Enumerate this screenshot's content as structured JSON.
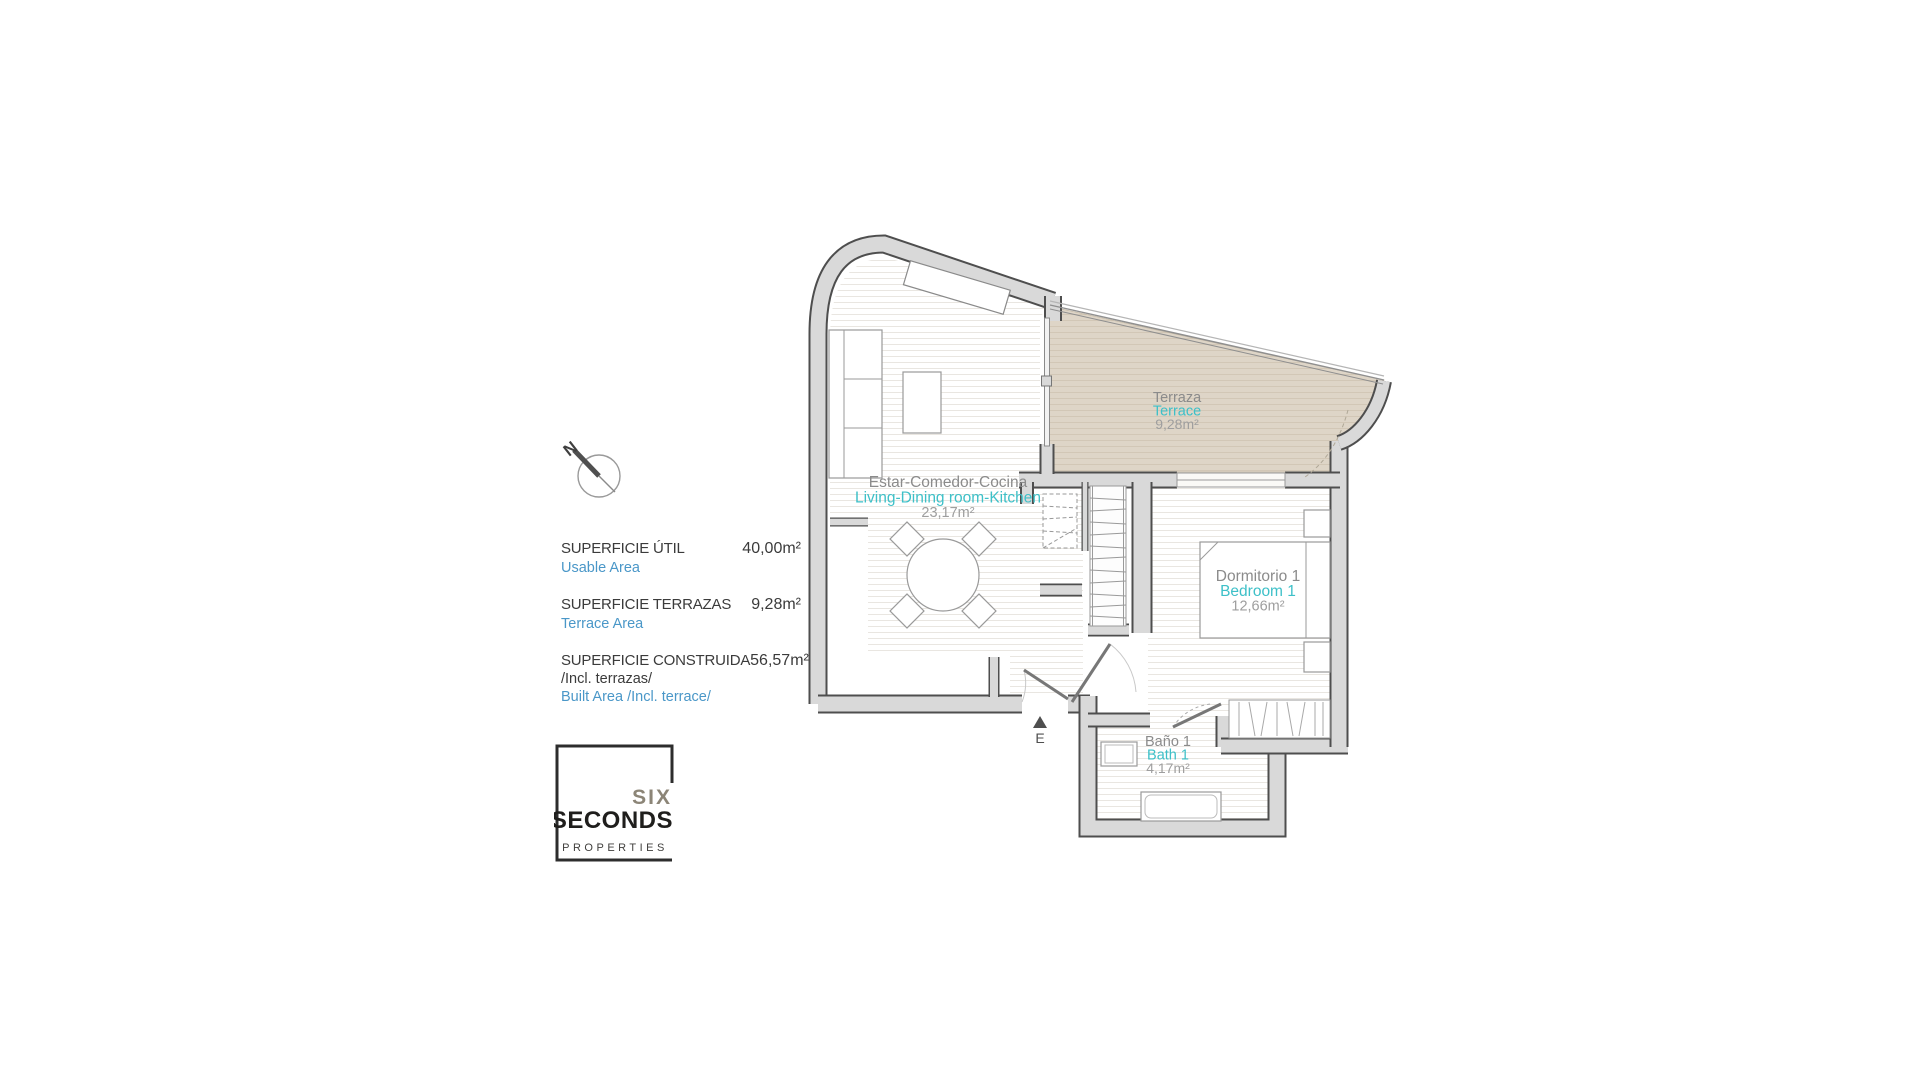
{
  "compass": {
    "label": "N"
  },
  "legend": {
    "rows": [
      {
        "title": "SUPERFICIE ÚTIL",
        "subtitle": "Usable Area",
        "value": "40,00m²"
      },
      {
        "title": "SUPERFICIE TERRAZAS",
        "subtitle": "Terrace Area",
        "value": "9,28m²"
      },
      {
        "title": "SUPERFICIE CONSTRUIDA",
        "title2": "/Incl. terrazas/",
        "subtitle": "Built Area /Incl. terrace/",
        "value": "56,57m²"
      }
    ]
  },
  "logo": {
    "word1": "SIX",
    "word2": "SECONDS",
    "word3": "PROPERTIES"
  },
  "floorplan": {
    "entrance_label": "E",
    "rooms": {
      "living": {
        "name_es": "Estar-Comedor-Cocina",
        "name_en": "Living-Dining room-Kitchen",
        "area": "23,17m²"
      },
      "terrace": {
        "name_es": "Terraza",
        "name_en": "Terrace",
        "area": "9,28m²"
      },
      "bedroom": {
        "name_es": "Dormitorio 1",
        "name_en": "Bedroom 1",
        "area": "12,66m²"
      },
      "bath": {
        "name_es": "Baño 1",
        "name_en": "Bath 1",
        "area": "4,17m²"
      }
    },
    "colors": {
      "teal": "#3dc0c8",
      "legend_blue": "#4a97c8",
      "label_gray": "#8b8b8b",
      "terrace_fill": "#ded5c7",
      "wall_fill": "#d9d9d9",
      "wall_edge": "#4e4e4e"
    }
  }
}
